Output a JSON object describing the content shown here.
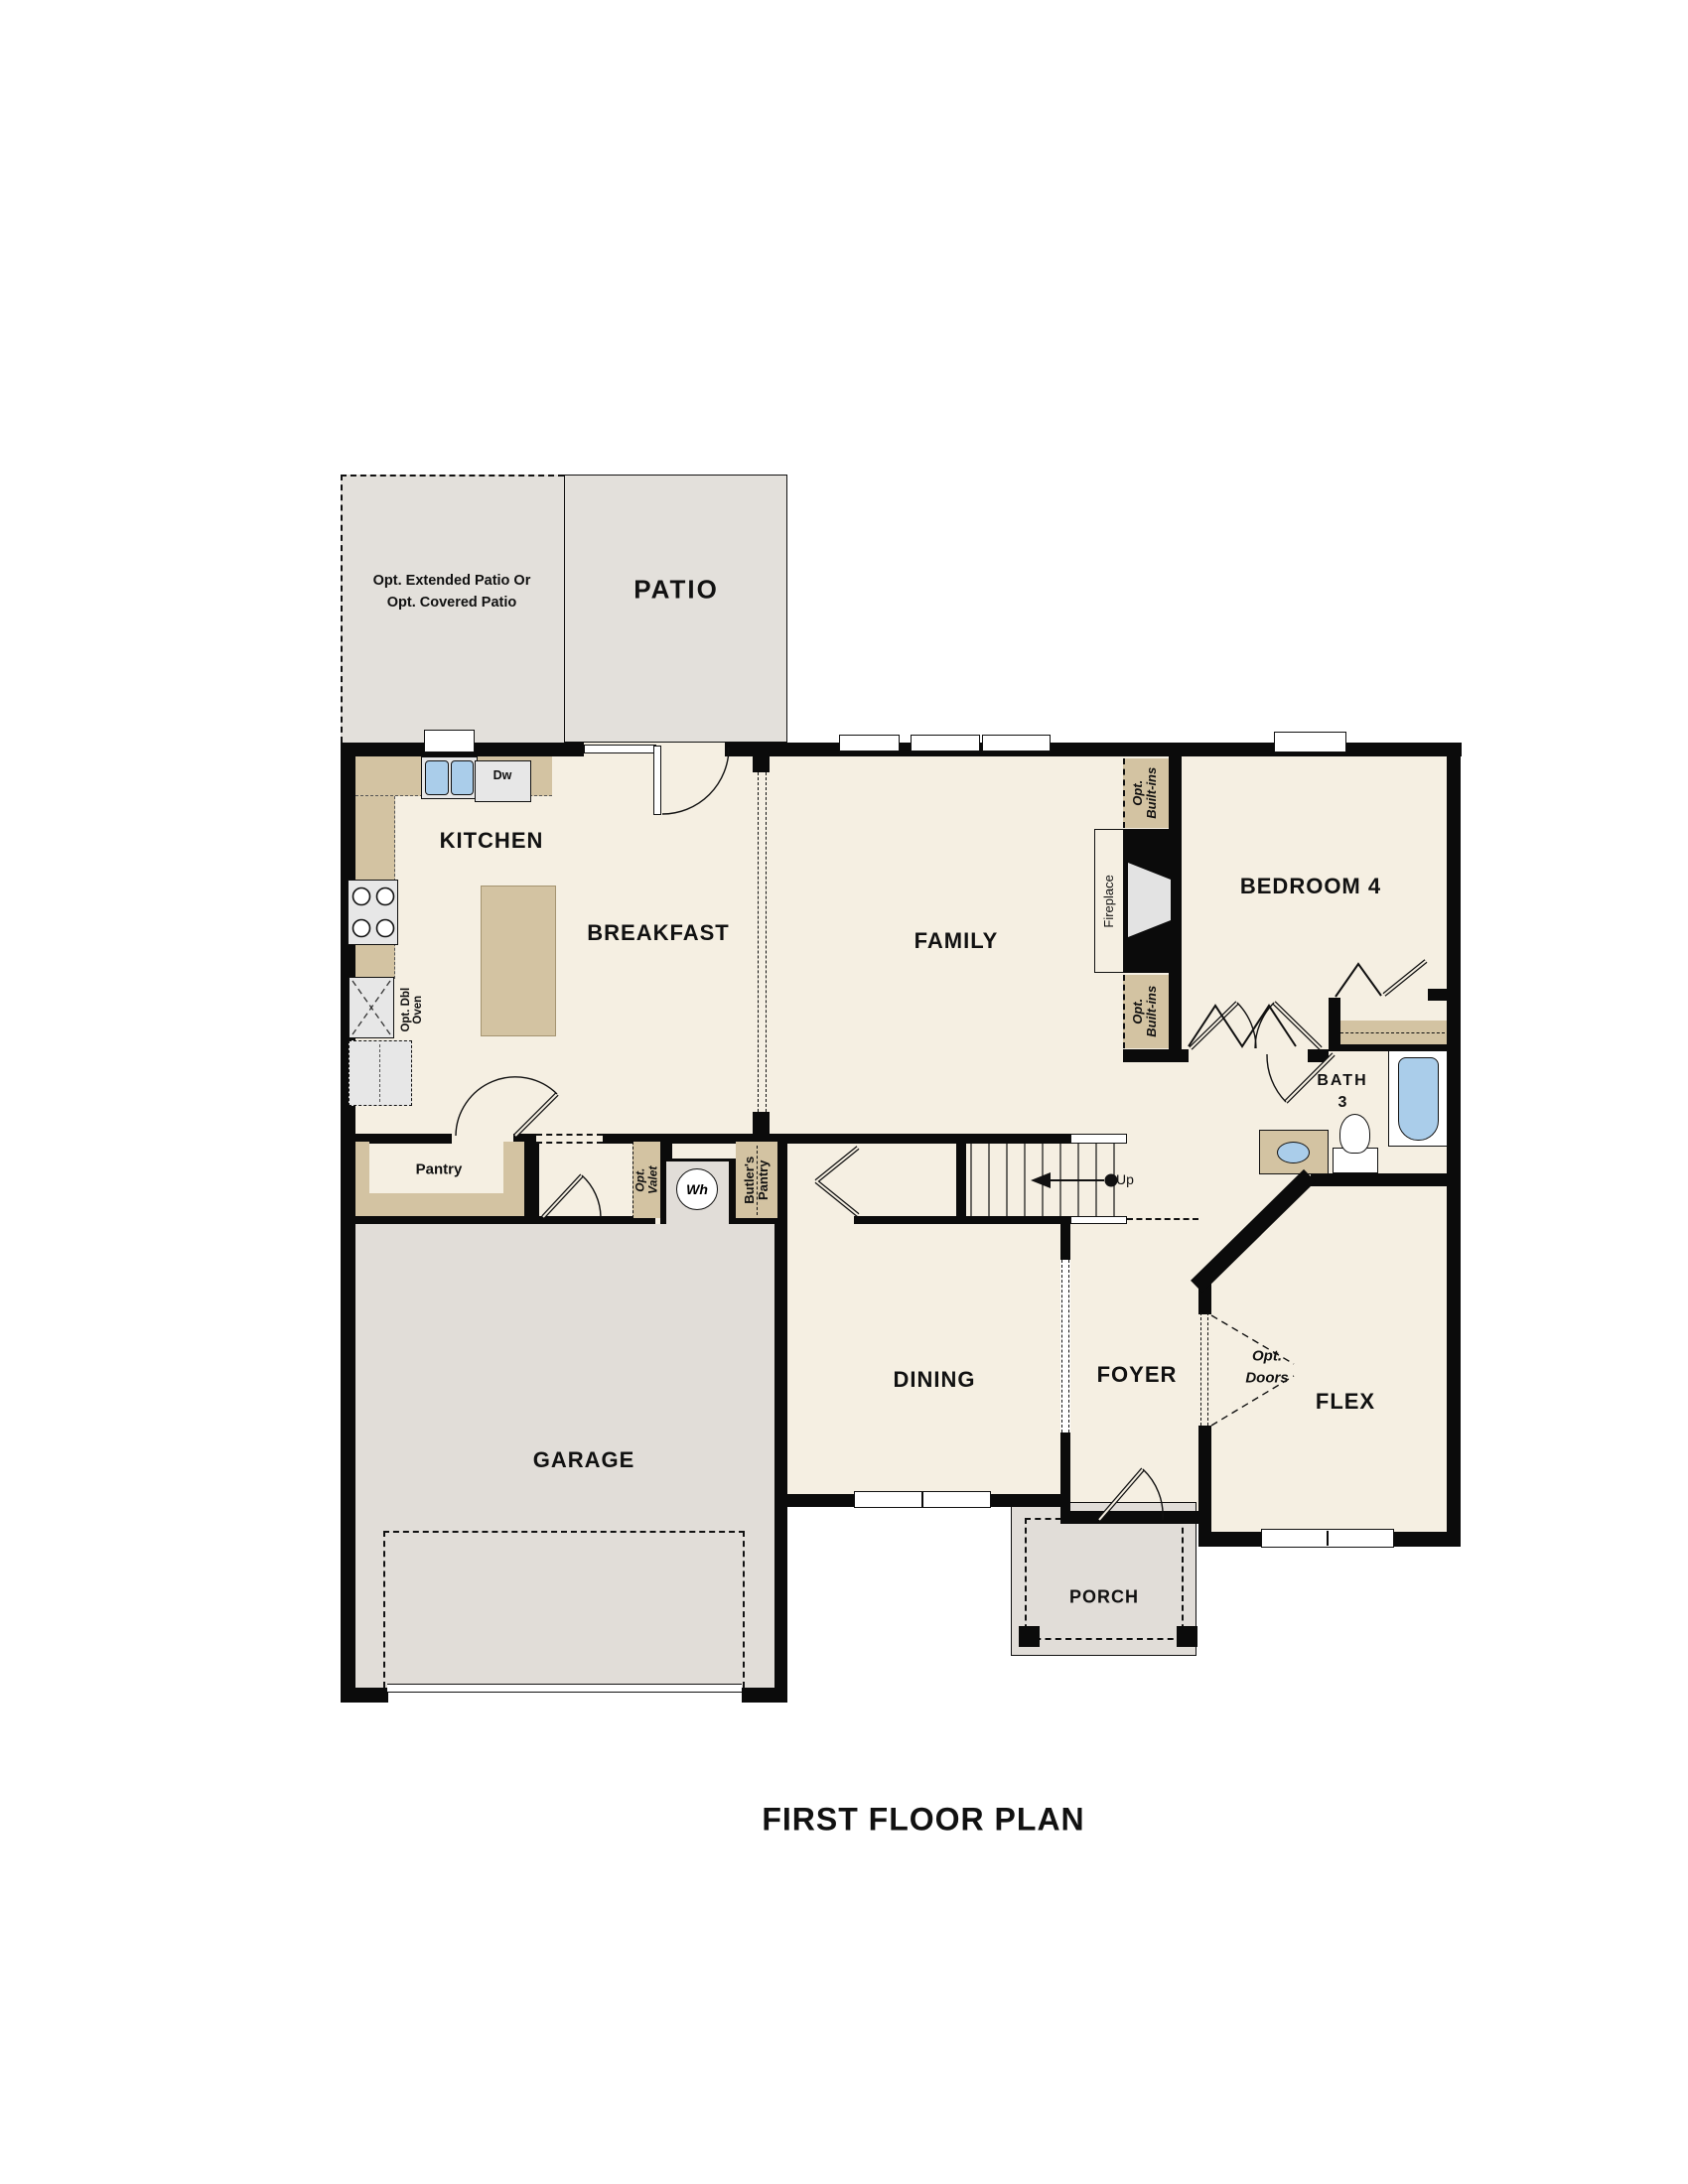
{
  "title": "FIRST FLOOR PLAN",
  "colors": {
    "floor_cream": "#f5efe2",
    "floor_gray": "#e1ddd8",
    "patio_gray": "#e3e0db",
    "cabinet_tan": "#d3c3a2",
    "appliance_gray": "#e7e7e7",
    "fixture_blue": "#aacdea",
    "wall_black": "#0b0b0b"
  },
  "outdoor": {
    "patio_label": "PATIO",
    "optional_patio": [
      "Opt. Extended Patio Or",
      "Opt. Covered Patio"
    ],
    "porch_label": "PORCH"
  },
  "rooms": {
    "kitchen": "KITCHEN",
    "breakfast": "BREAKFAST",
    "family": "FAMILY",
    "bedroom4": "BEDROOM 4",
    "bath3": [
      "BATH",
      "3"
    ],
    "dining": "DINING",
    "foyer": "FOYER",
    "flex": "FLEX",
    "garage": "GARAGE",
    "pantry": "Pantry"
  },
  "annotations": {
    "opt_built_ins": [
      "Opt.",
      "Built-ins"
    ],
    "fireplace": "Fireplace",
    "opt_dbl_oven": [
      "Opt. Dbl",
      "Oven"
    ],
    "dishwasher": "Dw",
    "water_heater": "Wh",
    "opt_valet": [
      "Opt.",
      "Valet"
    ],
    "butlers_pantry": [
      "Butler's",
      "Pantry"
    ],
    "opt_doors": [
      "Opt.",
      "Doors"
    ],
    "stairs_up": "Up"
  }
}
